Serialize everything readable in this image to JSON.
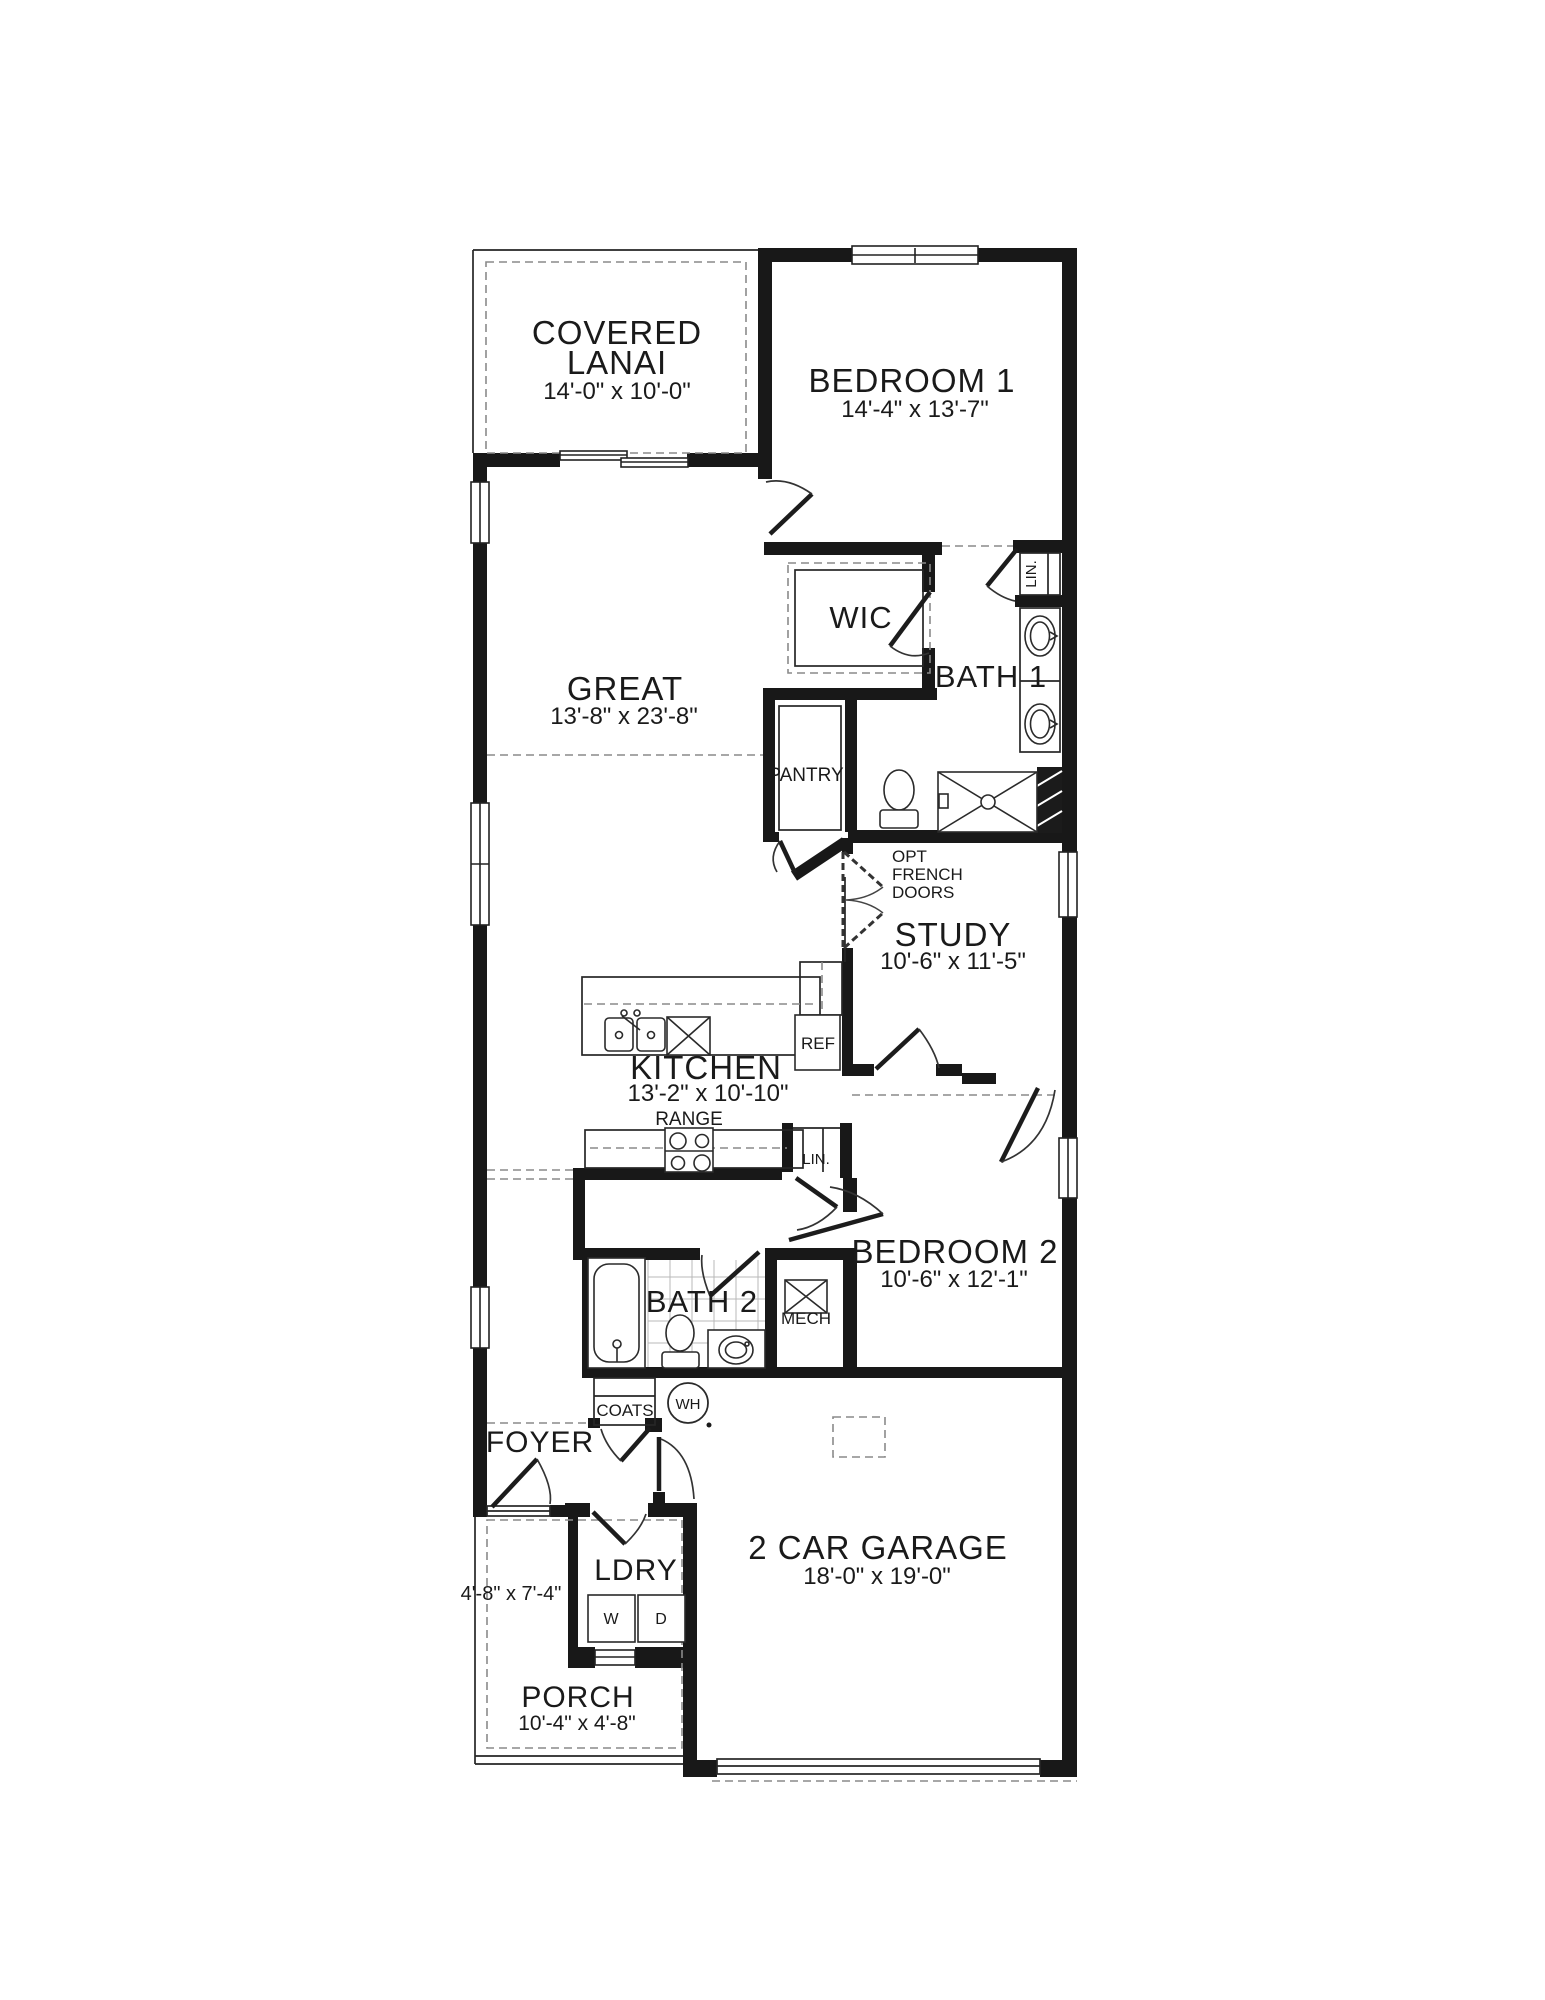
{
  "page": {
    "type": "architectural-floor-plan",
    "background": "#ffffff"
  },
  "colors": {
    "wall": "#181818",
    "line": "#262626",
    "dash": "#8a8a8a",
    "tile": "#b8b8b8",
    "text": "#1a1a1a"
  },
  "labels": {
    "lanai_line1": "COVERED",
    "lanai_line2": "LANAI",
    "lanai_dim": "14'-0\" x 10'-0\"",
    "bedroom1": "BEDROOM 1",
    "bedroom1_dim": "14'-4\" x 13'-7\"",
    "wic": "WIC",
    "bath1": "BATH 1",
    "lin_bath1": "LIN.",
    "pantry": "PANTRY",
    "great": "GREAT",
    "great_dim": "13'-8\" x 23'-8\"",
    "opt_line1": "OPT",
    "opt_line2": "FRENCH",
    "opt_line3": "DOORS",
    "study": "STUDY",
    "study_dim": "10'-6\" x 11'-5\"",
    "kitchen": "KITCHEN",
    "kitchen_dim": "13'-2\" x 10'-10\"",
    "ref": "REF",
    "range": "RANGE",
    "lin_hall": "LIN.",
    "bedroom2": "BEDROOM 2",
    "bedroom2_dim": "10'-6\" x 12'-1\"",
    "bath2": "BATH 2",
    "mech": "MECH",
    "coats": "COATS",
    "wh": "WH",
    "foyer": "FOYER",
    "foyer_dim": "4'-8\" x 7'-4\"",
    "ldry": "LDRY",
    "washer": "W",
    "dryer": "D",
    "porch": "PORCH",
    "porch_dim": "10'-4\" x 4'-8\"",
    "garage": "2 CAR GARAGE",
    "garage_dim": "18'-0\" x 19'-0\""
  }
}
